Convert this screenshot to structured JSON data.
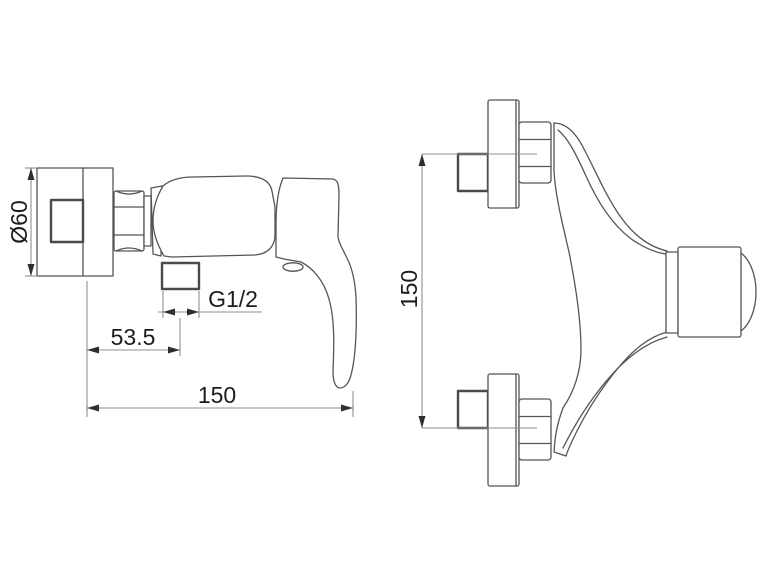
{
  "drawing": {
    "background_color": "#ffffff",
    "object_line_color": "#555555",
    "dimension_line_color": "#8f8f8f",
    "text_color": "#1c1c1c",
    "side_view": {
      "diameter_label": "Ø60",
      "thread_label": "G1/2",
      "outlet_offset_label": "53.5",
      "overall_width_label": "150"
    },
    "front_view": {
      "center_distance_label": "150"
    }
  }
}
